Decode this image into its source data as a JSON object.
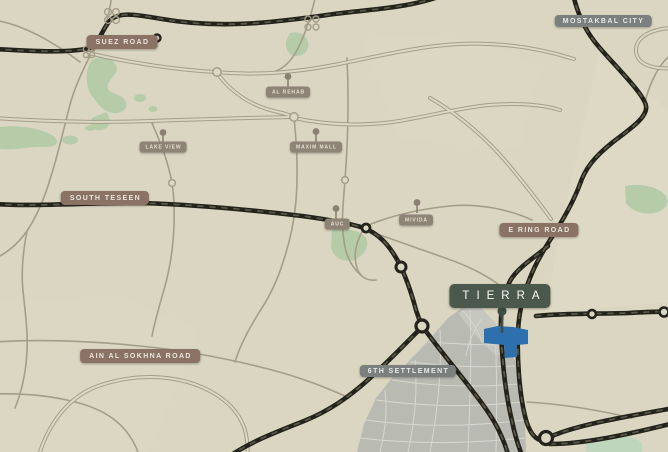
{
  "map": {
    "highways": [
      {
        "id": "suez-road",
        "label": "SUEZ ROAD"
      },
      {
        "id": "south-teseen",
        "label": "SOUTH TESEEN"
      },
      {
        "id": "e-ring-road",
        "label": "E RING ROAD"
      },
      {
        "id": "ain-al-sokhna-road",
        "label": "AIN AL SOKHNA ROAD"
      }
    ],
    "districts": [
      {
        "id": "mostakbal-city",
        "label": "MOSTAKBAL CITY"
      },
      {
        "id": "6th-settlement",
        "label": "6TH SETTLEMENT"
      }
    ],
    "landmarks": [
      {
        "id": "al-rehab",
        "label": "AL REHAB",
        "icon": "map-pin-icon"
      },
      {
        "id": "lake-view",
        "label": "LAKE VIEW",
        "icon": "map-pin-icon"
      },
      {
        "id": "maxim-mall",
        "label": "MAXIM MALL",
        "icon": "map-pin-icon"
      },
      {
        "id": "auc",
        "label": "AUC",
        "icon": "map-pin-icon"
      },
      {
        "id": "mivida",
        "label": "MIVIDA",
        "icon": "map-pin-icon"
      }
    ],
    "project": {
      "id": "tierra",
      "label": "TIERRA",
      "icon": "map-pin-icon"
    },
    "colors": {
      "background": "#dad6c1",
      "highway_badge": "#8a7265",
      "district_badge": "#7b807f",
      "landmark_badge": "#8e8476",
      "project_badge": "#4a594c",
      "major_road": "#23221b",
      "minor_road": "#a49e88",
      "green_area": "#b6cca9",
      "settlement_fill": "#b9bab2",
      "project_plot": "#2e6fad"
    }
  }
}
